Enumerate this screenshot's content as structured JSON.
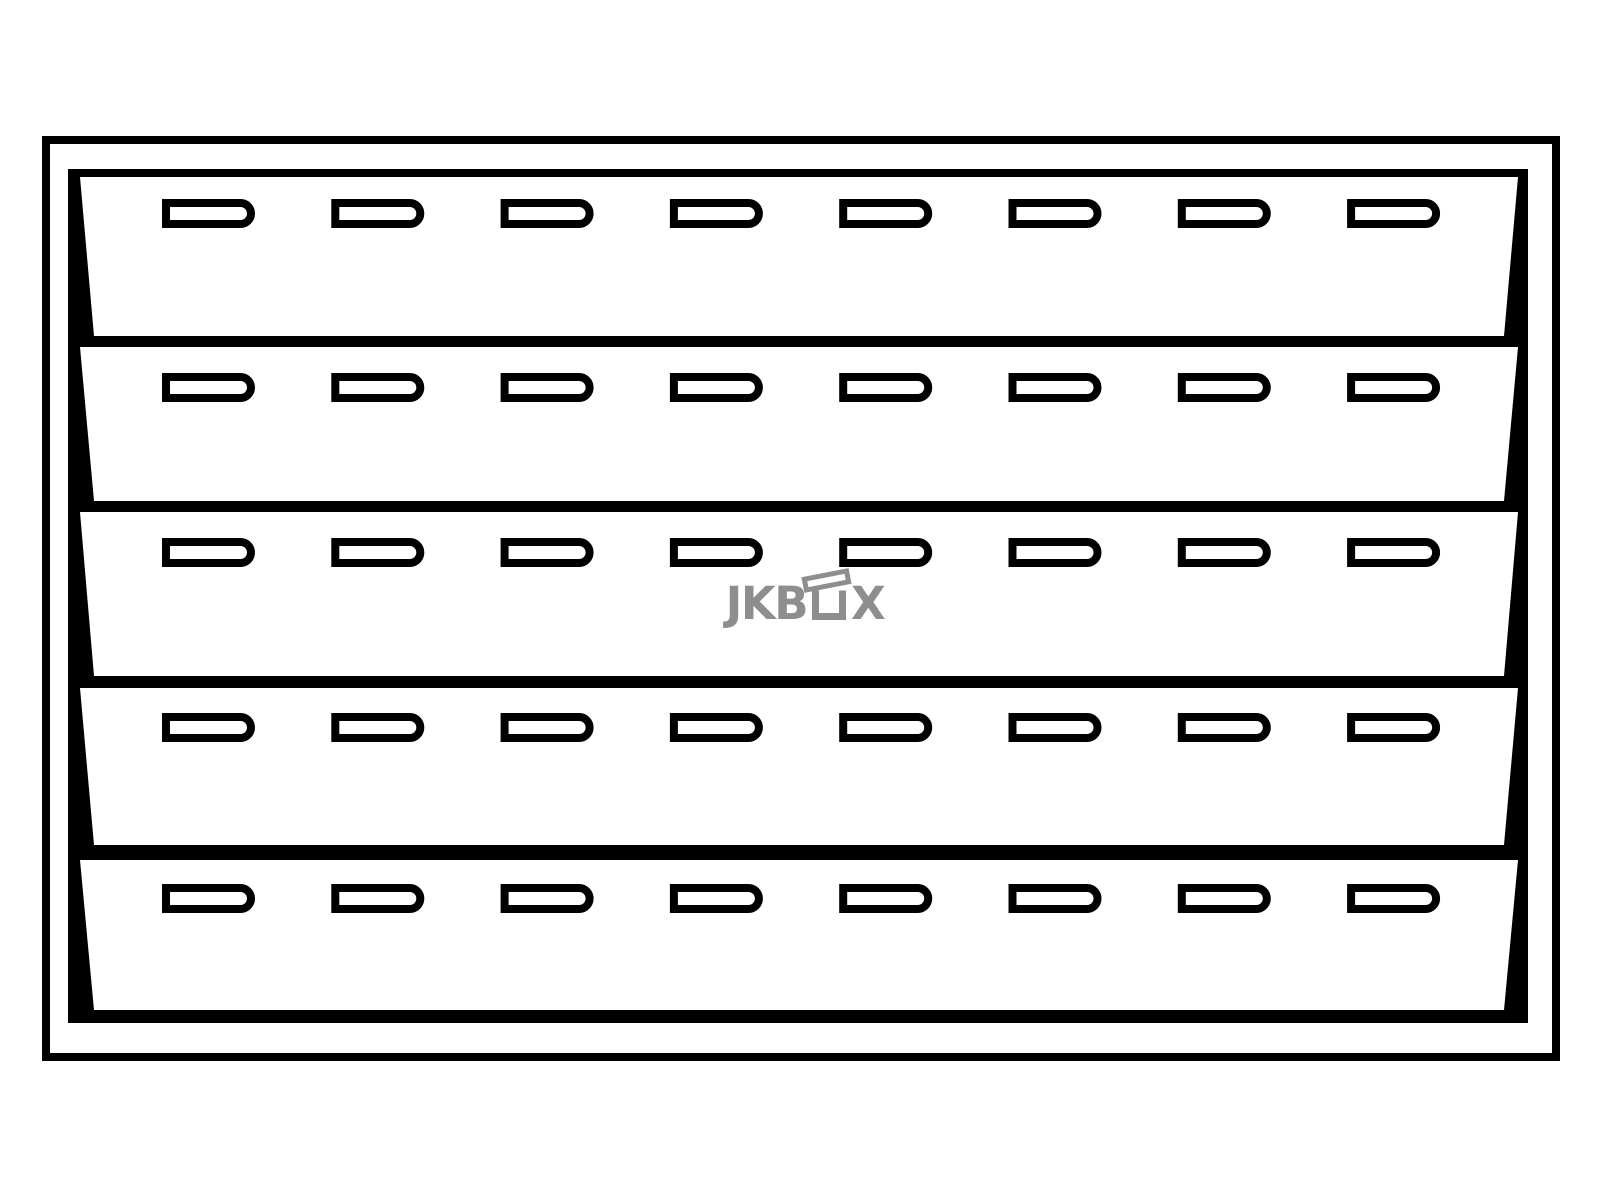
{
  "page": {
    "width": 1600,
    "height": 1200,
    "background": "#ffffff"
  },
  "watermark": {
    "text_left": "JKB",
    "text_right": "X",
    "icon": "open-box-icon",
    "color": "#8e8e8e"
  },
  "drawing": {
    "ink": "#000000",
    "paper": "#ffffff",
    "frame": {
      "x": 46,
      "y": 140,
      "width": 1510,
      "height": 917,
      "stroke_width": 8
    },
    "back": {
      "left": 68,
      "top": 169,
      "right": 1528,
      "bottom": 1023
    },
    "panel_slant": {
      "top_left": 80,
      "top_right": 1518,
      "bottom_left": 94,
      "bottom_right": 1504
    },
    "trays": [
      {
        "top": 177,
        "bottom": 336,
        "slot_y": 199
      },
      {
        "top": 347,
        "bottom": 501,
        "slot_y": 373
      },
      {
        "top": 512,
        "bottom": 676,
        "slot_y": 538
      },
      {
        "top": 688,
        "bottom": 845,
        "slot_y": 713
      },
      {
        "top": 860,
        "bottom": 1010,
        "slot_y": 884
      }
    ],
    "slots": {
      "count": 8,
      "first_x": 162,
      "pitch": 169.3,
      "width": 93,
      "height": 29,
      "stroke_width": 8
    },
    "tray_count": 5
  }
}
